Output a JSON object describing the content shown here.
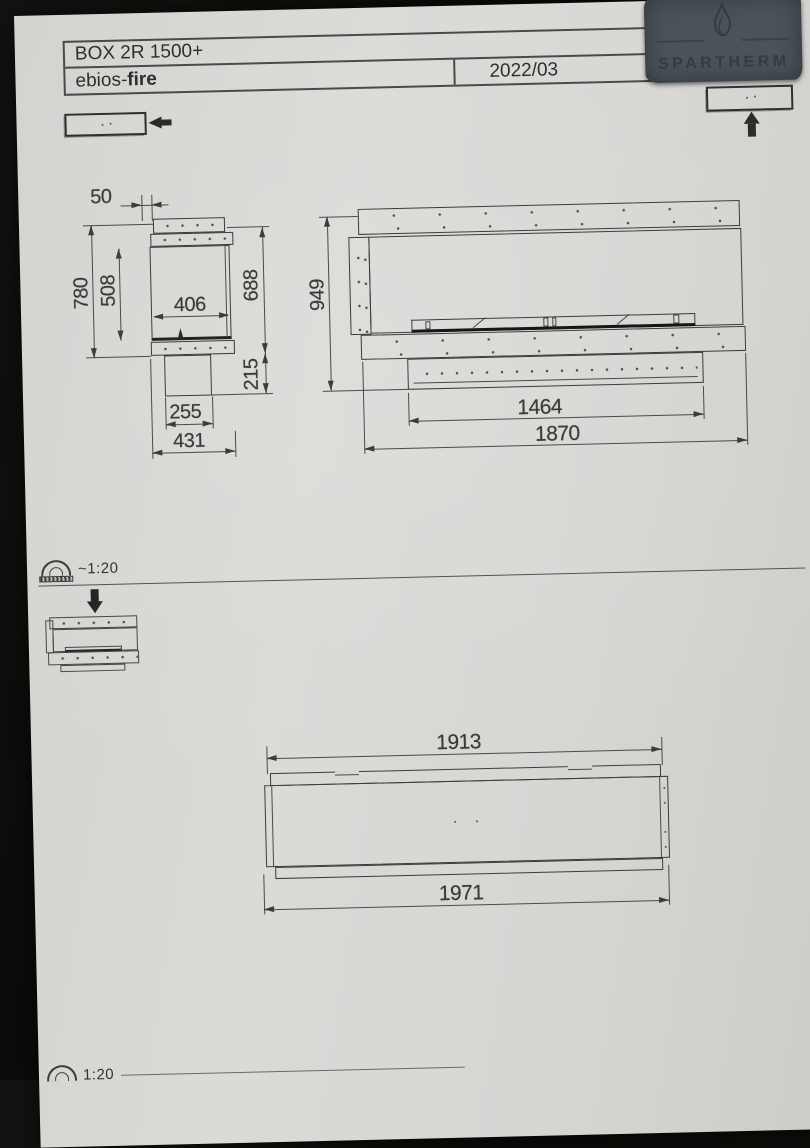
{
  "document": {
    "title": "BOX 2R 1500+",
    "brand": {
      "prefix": "ebios-",
      "bold": "fire"
    },
    "date": "2022/03",
    "logo_text": "SPARTHERM",
    "scale_label": "~1:20",
    "bottom_scale_label": "1:20"
  },
  "dimensions": {
    "side_view": {
      "top_offset": "50",
      "overall_height": "780",
      "opening_height": "508",
      "inner_depth": "406",
      "body_height": "688",
      "duct_height": "215",
      "duct_width": "255",
      "base_depth": "431"
    },
    "front_view": {
      "overall_height": "949",
      "opening_width": "1464",
      "overall_width": "1870"
    },
    "plan_view": {
      "glass_width": "1913",
      "overall_width": "1971"
    }
  }
}
